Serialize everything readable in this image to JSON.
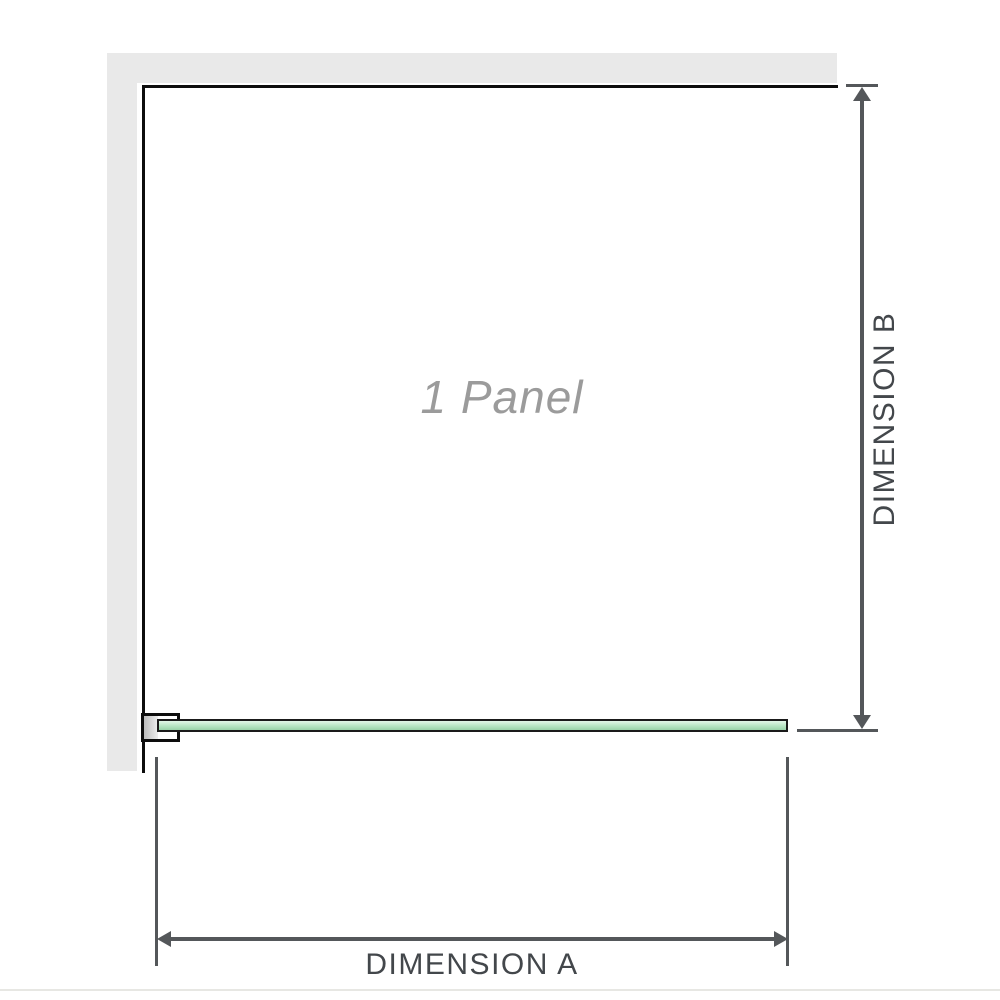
{
  "figure": {
    "panel_label": "1 Panel",
    "dimension_a": {
      "label": "DIMENSION A"
    },
    "dimension_b": {
      "label": "DIMENSION B"
    }
  },
  "icons": {
    "dimension_b_top": "arrow-up-icon",
    "dimension_b_bottom": "arrow-down-icon",
    "dimension_a_left": "arrow-left-icon",
    "dimension_a_right": "arrow-right-icon"
  },
  "colors": {
    "wall": "#e9e9e9",
    "outline": "#0d0d0d",
    "glass_border": "#1a1a1a",
    "glass_light": "#e3f6e8",
    "glass_mid": "#b7e5c3",
    "glass_dark": "#99d2a8",
    "bracket_pad_light": "#efefef",
    "bracket_pad_dark": "#bcbcbc",
    "dimension_line": "#54575a",
    "dimension_text": "#43474b",
    "panel_text": "#9b9b9b",
    "divider": "#e7e7e3"
  }
}
